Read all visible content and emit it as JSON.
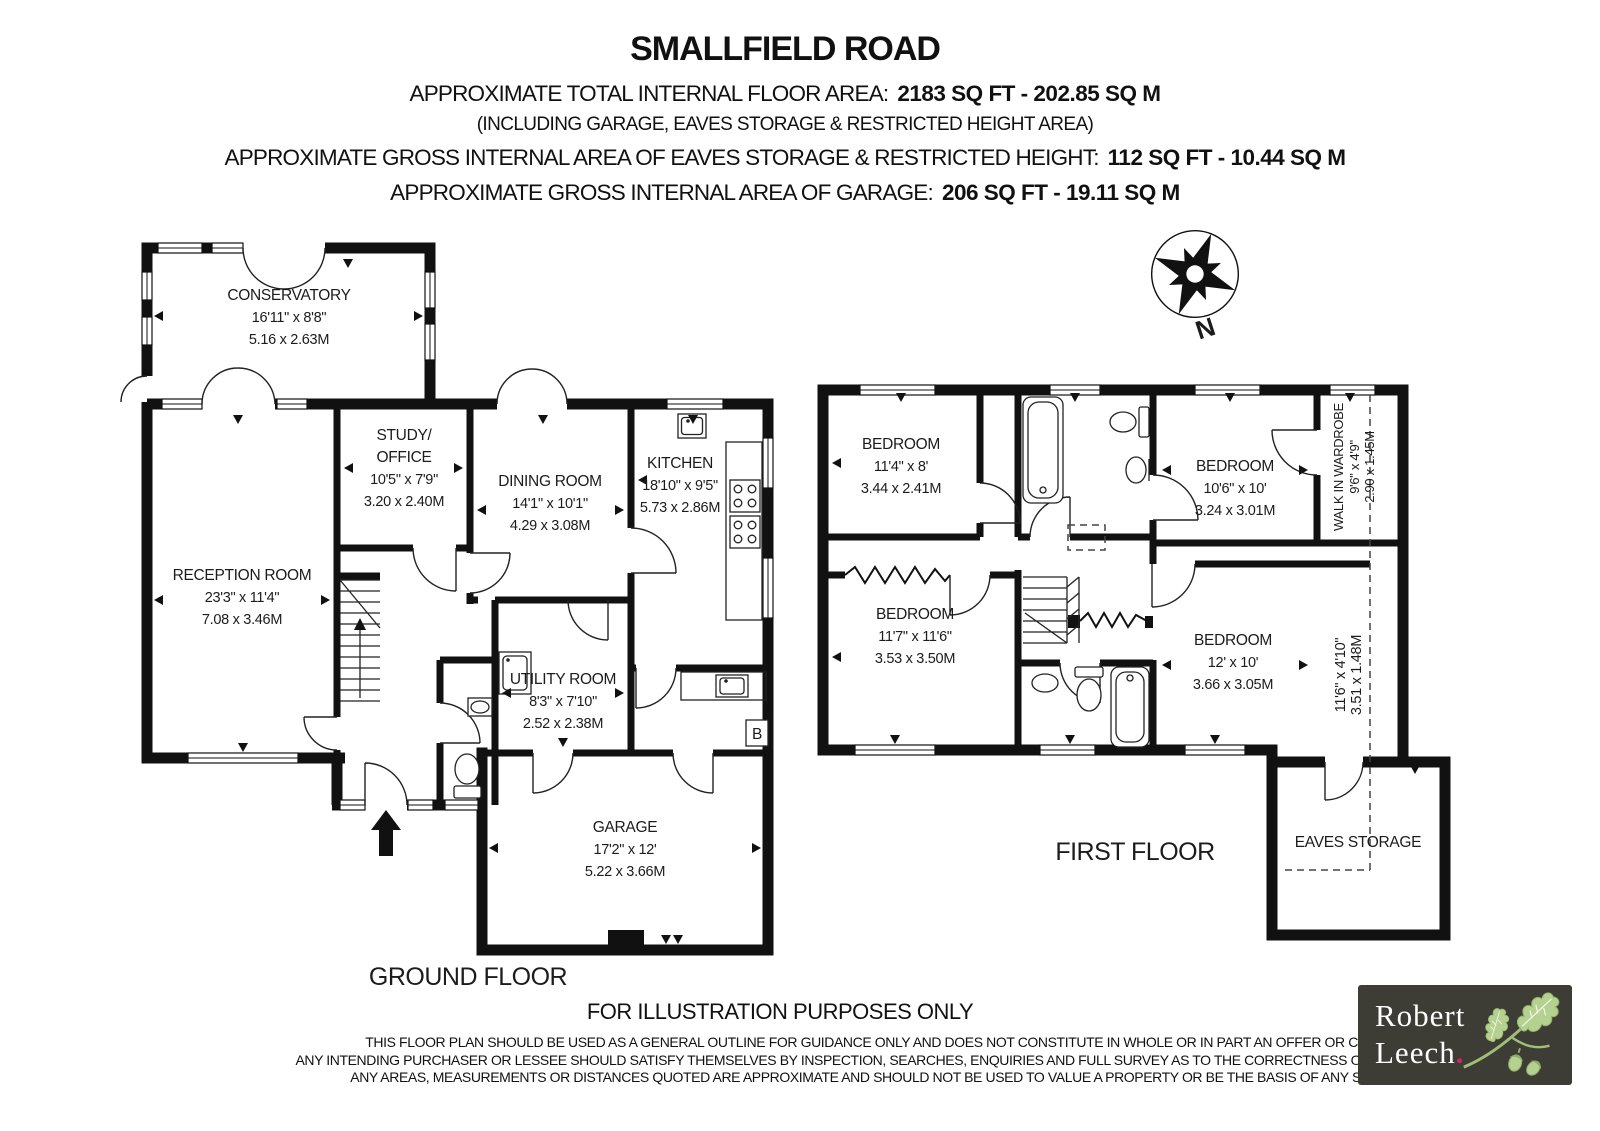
{
  "header": {
    "title": "SMALLFIELD ROAD",
    "total_area_label": "APPROXIMATE TOTAL INTERNAL FLOOR AREA:",
    "total_area_value": "2183 SQ FT  -  202.85 SQ M",
    "including_note": "(INCLUDING GARAGE, EAVES STORAGE & RESTRICTED HEIGHT AREA)",
    "eaves_area_label": "APPROXIMATE GROSS INTERNAL AREA OF EAVES STORAGE & RESTRICTED HEIGHT:",
    "eaves_area_value": "112 SQ FT  - 10.44 SQ M",
    "garage_area_label": "APPROXIMATE GROSS INTERNAL AREA OF GARAGE:",
    "garage_area_value": "206 SQ FT  -  19.11 SQ M"
  },
  "compass": {
    "north_label": "N"
  },
  "ground_floor": {
    "floor_label": "GROUND FLOOR",
    "boiler_label": "B",
    "rooms": {
      "conservatory": {
        "name": "CONSERVATORY",
        "imperial": "16'11\" x 8'8\"",
        "metric": "5.16 x 2.63M"
      },
      "reception": {
        "name": "RECEPTION ROOM",
        "imperial": "23'3\" x 11'4\"",
        "metric": "7.08 x 3.46M"
      },
      "study": {
        "name_line1": "STUDY/",
        "name_line2": "OFFICE",
        "imperial": "10'5\" x 7'9\"",
        "metric": "3.20 x 2.40M"
      },
      "dining": {
        "name": "DINING ROOM",
        "imperial": "14'1\" x 10'1\"",
        "metric": "4.29 x 3.08M"
      },
      "kitchen": {
        "name": "KITCHEN",
        "imperial": "18'10\" x 9'5\"",
        "metric": "5.73 x 2.86M"
      },
      "utility": {
        "name": "UTILITY ROOM",
        "imperial": "8'3\" x 7'10\"",
        "metric": "2.52 x 2.38M"
      },
      "garage": {
        "name": "GARAGE",
        "imperial": "17'2\" x 12'",
        "metric": "5.22 x 3.66M"
      }
    }
  },
  "first_floor": {
    "floor_label": "FIRST FLOOR",
    "rooms": {
      "bedroom_top_left": {
        "name": "BEDROOM",
        "imperial": "11'4\" x 8'",
        "metric": "3.44 x 2.41M"
      },
      "bedroom_top_right": {
        "name": "BEDROOM",
        "imperial": "10'6\" x  10'",
        "metric": "3.24 x 3.01M"
      },
      "bedroom_bottom_left": {
        "name": "BEDROOM",
        "imperial": "11'7\" x 11'6\"",
        "metric": "3.53 x 3.50M"
      },
      "bedroom_bottom_right": {
        "name": "BEDROOM",
        "imperial": "12' x 10'",
        "metric": "3.66 x 3.05M"
      },
      "walk_in_wardrobe": {
        "name": "WALK IN WARDROBE",
        "imperial": "9'6\" x 4'9\"",
        "metric": "2.90 x 1.45M"
      },
      "restricted_height": {
        "imperial": "11'6\" x 4'10\"",
        "metric": "3.51 x 1.48M"
      },
      "eaves_storage": {
        "name": "EAVES STORAGE"
      }
    }
  },
  "footer": {
    "illustration_note": "FOR ILLUSTRATION PURPOSES ONLY",
    "disclaimer_line1": "THIS FLOOR PLAN SHOULD BE USED AS A GENERAL OUTLINE FOR GUIDANCE ONLY AND DOES NOT CONSTITUTE IN WHOLE OR IN PART AN OFFER OR CONTRACT.",
    "disclaimer_line2": "ANY INTENDING PURCHASER OR LESSEE SHOULD SATISFY THEMSELVES BY INSPECTION, SEARCHES, ENQUIRIES AND FULL SURVEY AS TO THE CORRECTNESS OF EACH STATEMENT.",
    "disclaimer_line3": "ANY AREAS, MEASUREMENTS OR DISTANCES QUOTED ARE APPROXIMATE AND SHOULD NOT BE USED TO VALUE A PROPERTY OR BE THE BASIS OF ANY SALE OR LET."
  },
  "logo": {
    "name_line1": "Robert",
    "name_line2": "Leech",
    "dot": ".",
    "colors": {
      "background": "#3d3d35",
      "text": "#ffffff",
      "dot": "#c8285a",
      "leaves": "#b4d18f"
    }
  },
  "colors": {
    "walls": "#111111",
    "paper": "#ffffff"
  }
}
